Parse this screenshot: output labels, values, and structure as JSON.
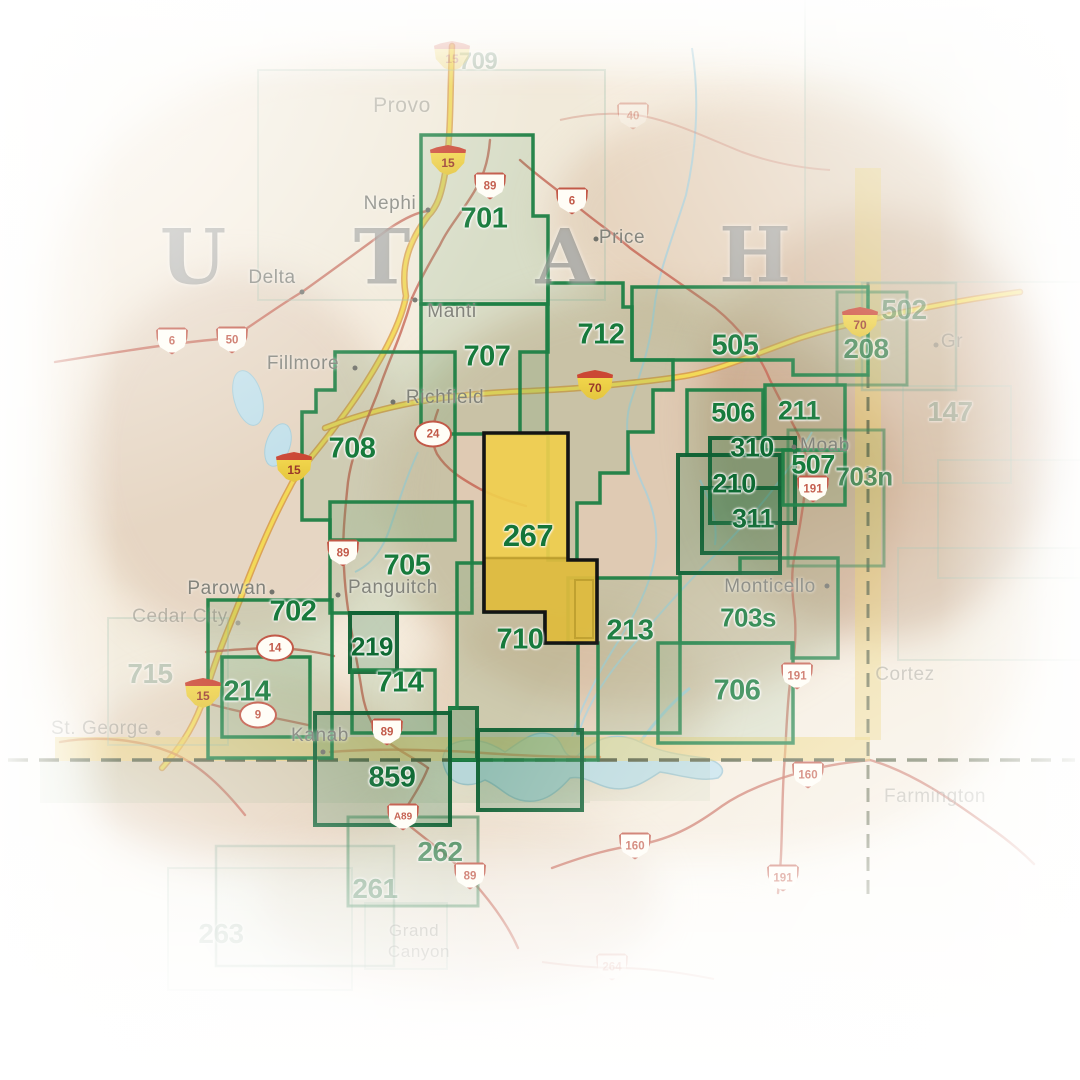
{
  "map_title": "Utah Trails Illustrated map index",
  "colors": {
    "accent_green": "#1e8044",
    "dark_green": "#0f6134",
    "highlight_yellow": "#efce4d",
    "highlight_outline": "#141414",
    "band_yellow": "#e9cb60",
    "border_dash": "#5a6243",
    "road_red": "#c4604f",
    "interstate_core": "#f3d957",
    "interstate_casing": "#d89a44",
    "water_blue": "#a9cfdb",
    "lake_fill": "#c2e0ea"
  },
  "state_letters": [
    {
      "ch": "U",
      "x": 193,
      "y": 257
    },
    {
      "ch": "T",
      "x": 382,
      "y": 257
    },
    {
      "ch": "A",
      "x": 565,
      "y": 257
    },
    {
      "ch": "H",
      "x": 755,
      "y": 255
    }
  ],
  "regions": [
    {
      "id": "ghost-northeast",
      "style": "ghost",
      "rect": [
        805,
        -30,
        320,
        312
      ]
    },
    {
      "id": "709",
      "label": "709",
      "style": "ghost",
      "rect": [
        258,
        70,
        347,
        230
      ],
      "lx": 478,
      "ly": 62,
      "fs": 24
    },
    {
      "id": "715",
      "label": "715",
      "style": "ghost",
      "rect": [
        108,
        618,
        120,
        127
      ],
      "lx": 150,
      "ly": 674,
      "fs": 28
    },
    {
      "id": "147",
      "label": "147",
      "style": "ghost",
      "rect": [
        903,
        386,
        108,
        97
      ],
      "lx": 950,
      "ly": 412,
      "fs": 28
    },
    {
      "id": "ghost-east-1",
      "style": "ghost",
      "rect": [
        938,
        460,
        150,
        118
      ]
    },
    {
      "id": "ghost-east-2",
      "style": "ghost",
      "rect": [
        898,
        548,
        185,
        112
      ]
    },
    {
      "id": "263",
      "label": "263",
      "style": "ghost",
      "rect": [
        168,
        868,
        184,
        122
      ],
      "lx": 221,
      "ly": 934,
      "fs": 28
    },
    {
      "id": "grand-canyon-box",
      "style": "ghost",
      "rect": [
        365,
        903,
        82,
        66
      ]
    },
    {
      "id": "502",
      "label": "502",
      "style": "faint",
      "rect": [
        862,
        283,
        94,
        107
      ],
      "lx": 904,
      "ly": 310,
      "fs": 28
    },
    {
      "id": "261",
      "label": "261",
      "style": "faint",
      "rect": [
        216,
        846,
        178,
        120
      ],
      "lx": 375,
      "ly": 889,
      "fs": 28
    },
    {
      "id": "262",
      "label": "262",
      "style": "medium",
      "rect": [
        348,
        817,
        130,
        89
      ],
      "lx": 440,
      "ly": 852,
      "fs": 28
    },
    {
      "id": "208",
      "label": "208",
      "style": "medium",
      "rect": [
        837,
        292,
        70,
        93
      ],
      "lx": 866,
      "ly": 349,
      "fs": 28
    },
    {
      "id": "703n",
      "label": "703n",
      "style": "medium",
      "rect": [
        788,
        430,
        96,
        136
      ],
      "lx": 864,
      "ly": 477,
      "fs": 26
    },
    {
      "id": "505",
      "label": "505",
      "style": "strong",
      "points": "632,287 868,287 868,375 793,375 793,360 632,360",
      "lx": 735,
      "ly": 346
    },
    {
      "id": "701",
      "label": "701",
      "style": "strong",
      "points": "421,135 533,135 533,216 548,216 548,304 421,304",
      "lx": 484,
      "ly": 219
    },
    {
      "id": "707",
      "label": "707",
      "style": "strong",
      "rect": [
        421,
        304,
        126,
        130
      ],
      "lx": 487,
      "ly": 357
    },
    {
      "id": "708",
      "label": "708",
      "style": "strong",
      "points": "335,352 455,352 455,540 330,540 330,520 302,520 302,412 316,412 316,390 335,390",
      "lx": 352,
      "ly": 449
    },
    {
      "id": "712",
      "label": "712",
      "style": "strong",
      "points": "548,283 623,283 623,307 632,307 632,360 673,360 673,390 653,390 653,432 628,432 628,473 600,473 600,503 577,503 577,560 548,560 548,434 520,434 520,352 548,352",
      "lx": 601,
      "ly": 335
    },
    {
      "id": "705",
      "label": "705",
      "style": "strong",
      "rect": [
        330,
        502,
        142,
        111
      ],
      "lx": 407,
      "ly": 566
    },
    {
      "id": "702",
      "label": "702",
      "style": "strong",
      "rect": [
        208,
        600,
        124,
        158
      ],
      "lx": 293,
      "ly": 612
    },
    {
      "id": "214",
      "label": "214",
      "style": "strong",
      "rect": [
        222,
        657,
        88,
        80
      ],
      "lx": 247,
      "ly": 692
    },
    {
      "id": "219",
      "label": "219",
      "style": "dark",
      "rect": [
        350,
        613,
        47,
        59
      ],
      "lx": 372,
      "ly": 647,
      "fs": 26
    },
    {
      "id": "714",
      "label": "714",
      "style": "strong",
      "rect": [
        352,
        670,
        83,
        63
      ],
      "lx": 400,
      "ly": 683
    },
    {
      "id": "kanab-east-box",
      "style": "dark",
      "rect": [
        450,
        708,
        27,
        52
      ]
    },
    {
      "id": "213",
      "label": "213",
      "style": "strong",
      "points": "568,578 680,578 680,733 598,733 598,643 568,643",
      "lx": 630,
      "ly": 631
    },
    {
      "id": "710",
      "label": "710",
      "style": "strong",
      "points": "457,563 484,563 484,612 545,612 545,643 578,643 578,733 598,733 598,760 450,760 450,708 457,708",
      "lx": 520,
      "ly": 640
    },
    {
      "id": "703s",
      "label": "703s",
      "style": "strong",
      "points": "680,573 740,573 740,558 838,558 838,658 792,658 792,643 680,643",
      "lx": 748,
      "ly": 618,
      "fs": 26
    },
    {
      "id": "706",
      "label": "706",
      "style": "strong",
      "rect": [
        658,
        643,
        135,
        100
      ],
      "lx": 737,
      "ly": 691
    },
    {
      "id": "506",
      "label": "506",
      "style": "strong",
      "rect": [
        687,
        390,
        76,
        65
      ],
      "lx": 733,
      "ly": 413,
      "fs": 27
    },
    {
      "id": "211",
      "label": "211",
      "style": "strong",
      "rect": [
        765,
        385,
        80,
        65
      ],
      "lx": 799,
      "ly": 411,
      "fs": 27
    },
    {
      "id": "310",
      "label": "310",
      "style": "dark",
      "rect": [
        710,
        438,
        85,
        85
      ],
      "lx": 752,
      "ly": 448,
      "fs": 27
    },
    {
      "id": "210",
      "label": "210",
      "style": "dark",
      "rect": [
        678,
        455,
        102,
        118
      ],
      "lx": 734,
      "ly": 484,
      "fs": 27
    },
    {
      "id": "311",
      "label": "311",
      "style": "dark",
      "rect": [
        702,
        488,
        78,
        65
      ],
      "lx": 753,
      "ly": 519,
      "fs": 27
    },
    {
      "id": "507",
      "label": "507",
      "style": "strong",
      "rect": [
        783,
        450,
        62,
        55
      ],
      "lx": 813,
      "ly": 465,
      "fs": 27
    },
    {
      "id": "859-west",
      "label": "859",
      "style": "dark",
      "rect": [
        315,
        713,
        135,
        112
      ],
      "lx": 392,
      "ly": 778
    },
    {
      "id": "859-east",
      "style": "dark",
      "rect": [
        478,
        730,
        104,
        80
      ]
    }
  ],
  "highlight": {
    "id": "267",
    "label": "267",
    "lx": 528,
    "ly": 536,
    "fs": 31,
    "points": "484,433 568,433 568,560 597,560 597,643 545,643 545,612 484,612",
    "inner_dark": [
      "484,558 568,558 568,612 484,612",
      "568,560 597,560 597,643 545,643 545,612 568,612"
    ]
  },
  "cities": [
    {
      "name": "Provo",
      "x": 402,
      "y": 106,
      "style": "ghost",
      "fs": 21
    },
    {
      "name": "Nephi",
      "x": 390,
      "y": 204,
      "style": "normal",
      "dot": [
        428,
        210
      ]
    },
    {
      "name": "Delta",
      "x": 272,
      "y": 278,
      "style": "normal",
      "dot": [
        302,
        292
      ]
    },
    {
      "name": "Fillmore",
      "x": 303,
      "y": 364,
      "style": "normal",
      "dot": [
        355,
        368
      ]
    },
    {
      "name": "Manti",
      "x": 452,
      "y": 312,
      "style": "normal",
      "dot": [
        415,
        300
      ]
    },
    {
      "name": "Richfield",
      "x": 445,
      "y": 398,
      "style": "normal",
      "dot": [
        393,
        402
      ]
    },
    {
      "name": "Price",
      "x": 622,
      "y": 238,
      "style": "normal",
      "dot": [
        596,
        239
      ]
    },
    {
      "name": "Parowan",
      "x": 227,
      "y": 589,
      "style": "normal",
      "dot": [
        272,
        592
      ]
    },
    {
      "name": "Cedar City",
      "x": 180,
      "y": 617,
      "style": "ghost",
      "dot": [
        238,
        623
      ]
    },
    {
      "name": "Panguitch",
      "x": 393,
      "y": 588,
      "style": "normal",
      "dot": [
        338,
        595
      ]
    },
    {
      "name": "Kanab",
      "x": 320,
      "y": 736,
      "style": "normal",
      "dot": [
        323,
        752
      ]
    },
    {
      "name": "Moab",
      "x": 825,
      "y": 446,
      "style": "normal",
      "dot": [
        794,
        447
      ]
    },
    {
      "name": "Monticello",
      "x": 770,
      "y": 587,
      "style": "normal",
      "dot": [
        827,
        586
      ]
    },
    {
      "name": "Cortez",
      "x": 905,
      "y": 675,
      "style": "ghost"
    },
    {
      "name": "Farmington",
      "x": 935,
      "y": 797,
      "style": "ghost"
    },
    {
      "name": "St. George",
      "x": 100,
      "y": 729,
      "style": "ghost",
      "dot": [
        158,
        733
      ]
    },
    {
      "name": "Gr",
      "x": 952,
      "y": 342,
      "style": "ghost",
      "dot": [
        936,
        345
      ]
    },
    {
      "name": "Grand",
      "x": 414,
      "y": 931,
      "style": "ghost",
      "fs": 17
    },
    {
      "name": "Canyon",
      "x": 419,
      "y": 952,
      "style": "ghost",
      "fs": 17
    }
  ],
  "shields": [
    {
      "kind": "i",
      "num": "15",
      "x": 452,
      "y": 56,
      "ghost": true
    },
    {
      "kind": "i",
      "num": "15",
      "x": 448,
      "y": 160
    },
    {
      "kind": "i",
      "num": "15",
      "x": 294,
      "y": 467
    },
    {
      "kind": "i",
      "num": "15",
      "x": 203,
      "y": 693
    },
    {
      "kind": "i",
      "num": "70",
      "x": 595,
      "y": 385
    },
    {
      "kind": "i",
      "num": "70",
      "x": 860,
      "y": 322
    },
    {
      "kind": "us",
      "num": "89",
      "x": 490,
      "y": 186
    },
    {
      "kind": "us",
      "num": "89",
      "x": 343,
      "y": 553
    },
    {
      "kind": "us",
      "num": "89",
      "x": 387,
      "y": 732
    },
    {
      "kind": "us",
      "num": "89",
      "x": 470,
      "y": 876
    },
    {
      "kind": "usalt",
      "num": "A89",
      "x": 403,
      "y": 817
    },
    {
      "kind": "us",
      "num": "6",
      "x": 572,
      "y": 201
    },
    {
      "kind": "us",
      "num": "6",
      "x": 172,
      "y": 341
    },
    {
      "kind": "us",
      "num": "50",
      "x": 232,
      "y": 340
    },
    {
      "kind": "us",
      "num": "191",
      "x": 813,
      "y": 489
    },
    {
      "kind": "us",
      "num": "191",
      "x": 797,
      "y": 676
    },
    {
      "kind": "us",
      "num": "191",
      "x": 783,
      "y": 878
    },
    {
      "kind": "us",
      "num": "160",
      "x": 808,
      "y": 775
    },
    {
      "kind": "us",
      "num": "160",
      "x": 635,
      "y": 846
    },
    {
      "kind": "us",
      "num": "40",
      "x": 633,
      "y": 116,
      "ghost": true
    },
    {
      "kind": "us",
      "num": "264",
      "x": 612,
      "y": 967,
      "ghost": true
    },
    {
      "kind": "state",
      "num": "24",
      "x": 433,
      "y": 434
    },
    {
      "kind": "state",
      "num": "14",
      "x": 275,
      "y": 648
    },
    {
      "kind": "state",
      "num": "9",
      "x": 258,
      "y": 715
    }
  ],
  "borders": {
    "horizontal_dash_y": 760,
    "vertical_dash_x": 868
  }
}
